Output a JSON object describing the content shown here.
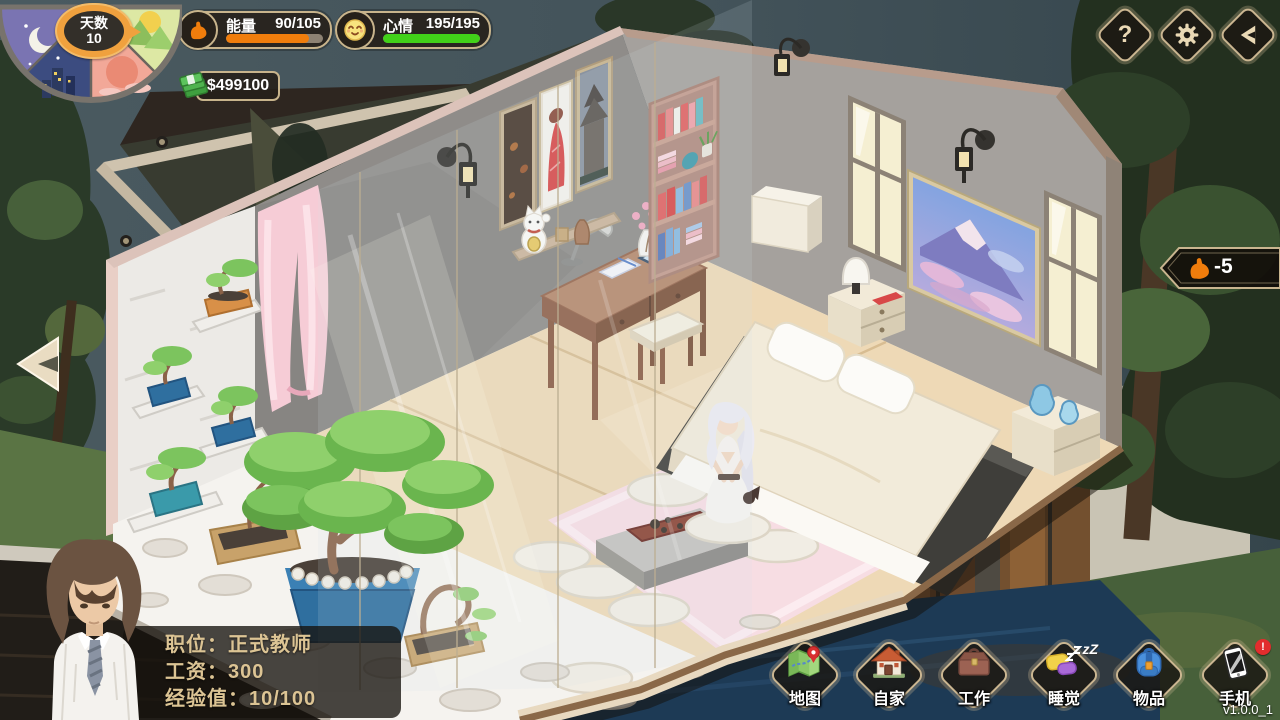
{
  "hud": {
    "day": {
      "label": "天数",
      "value": "10"
    },
    "energy": {
      "label": "能量",
      "value": "90/105",
      "percent": 86,
      "bar_color": "#f07d0c",
      "icon": "muscle-arm-icon"
    },
    "mood": {
      "label": "心情",
      "value": "195/195",
      "percent": 100,
      "bar_color": "#41d119",
      "icon": "smiley-icon"
    },
    "money": {
      "value": "$499100",
      "icon": "cash-icon"
    },
    "energy_popup": {
      "value": "-5",
      "icon": "muscle-arm-icon"
    },
    "top_buttons": [
      {
        "id": "help",
        "icon": "question-icon",
        "glyph": "?"
      },
      {
        "id": "settings",
        "icon": "gear-icon"
      },
      {
        "id": "collapse",
        "icon": "arrow-left-icon"
      }
    ],
    "colors": {
      "ui_border": "#c8b48c",
      "energy": "#f07d0c",
      "mood": "#41d119",
      "money_icon": "#4fb34f"
    }
  },
  "player": {
    "rows": [
      {
        "text": "职位：正式教师"
      },
      {
        "text": "工资：300"
      },
      {
        "text": "经验值：10/100"
      }
    ]
  },
  "actions": [
    {
      "id": "map",
      "label": "地图",
      "icon": "map-icon"
    },
    {
      "id": "home",
      "label": "自家",
      "icon": "house-icon"
    },
    {
      "id": "work",
      "label": "工作",
      "icon": "briefcase-icon"
    },
    {
      "id": "sleep",
      "label": "睡觉",
      "icon": "pillow-icon",
      "badge": "zZ"
    },
    {
      "id": "items",
      "label": "物品",
      "icon": "backpack-icon"
    },
    {
      "id": "phone",
      "label": "手机",
      "icon": "phone-icon",
      "badge": "!"
    }
  ],
  "version": "v1.0.0_1"
}
